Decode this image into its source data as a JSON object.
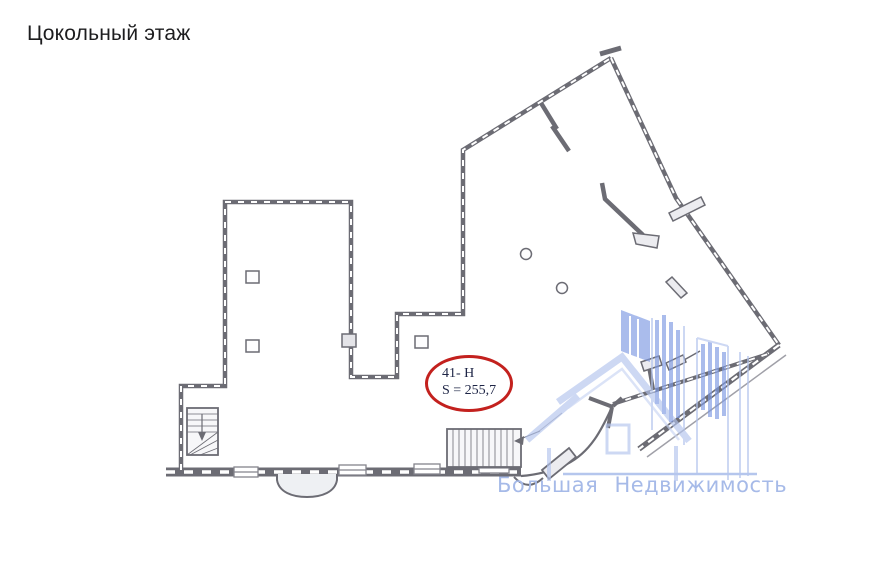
{
  "title": "Цокольный этаж",
  "plan": {
    "unit_callout": {
      "line1": "41- Н",
      "line2": "S = 255,7"
    },
    "colors": {
      "ellipse": "#c3211e",
      "callout_text": "#1d2445",
      "wall_line": "#6c6c74"
    }
  },
  "watermark": {
    "text": "Большая Недвижимость",
    "colors": {
      "text": "#a6bae8",
      "logo_solid": "#7d99e2",
      "logo_light": "#b3c4ee"
    }
  }
}
